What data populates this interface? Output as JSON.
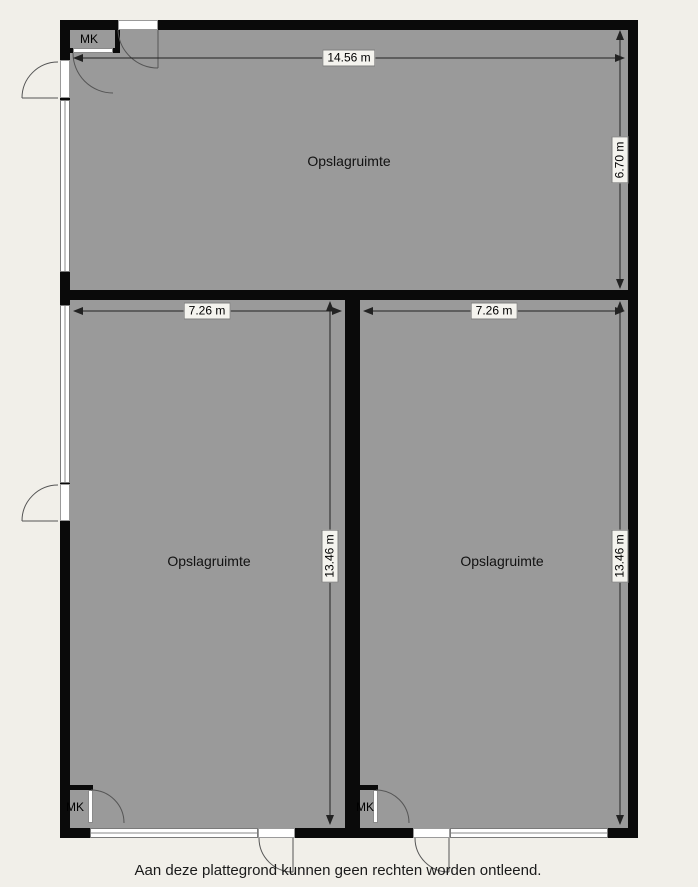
{
  "floorplan": {
    "rooms": {
      "top": {
        "name": "Opslagruimte",
        "width": "14.56 m",
        "height": "6.70 m"
      },
      "bottom_left": {
        "name": "Opslagruimte",
        "width": "7.26 m",
        "height": "13.46 m"
      },
      "bottom_right": {
        "name": "Opslagruimte",
        "width": "7.26 m",
        "height": "13.46 m"
      }
    },
    "closets": {
      "top_left": "MK",
      "bottom_left": "MK",
      "bottom_right": "MK"
    },
    "disclaimer": "Aan deze plattegrond kunnen geen rechten worden ontleend.",
    "colors": {
      "background": "#f1efe9",
      "room_fill": "#9a9a9a",
      "wall": "#0a0a0a",
      "window": "#ffffff",
      "dimension_line": "#222222",
      "label_background": "#f4f3ee"
    }
  }
}
